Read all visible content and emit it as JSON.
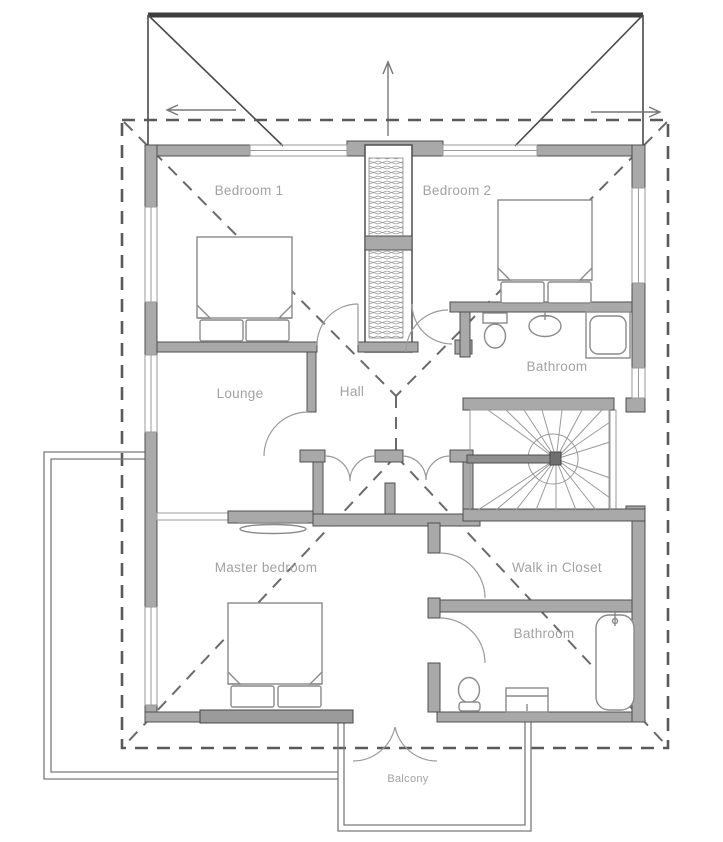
{
  "rooms": {
    "bedroom1": {
      "label": "Bedroom 1"
    },
    "bedroom2": {
      "label": "Bedroom 2"
    },
    "bathroom_upper": {
      "label": "Bathroom"
    },
    "lounge": {
      "label": "Lounge"
    },
    "hall": {
      "label": "Hall"
    },
    "master_bedroom": {
      "label": "Master bedroom"
    },
    "walk_in_closet": {
      "label": "Walk in Closet"
    },
    "bathroom_lower": {
      "label": "Bathroom"
    },
    "balcony": {
      "label": "Balcony"
    }
  },
  "colors": {
    "wall_fill": "#a9a9a9",
    "wall_outline": "#4f4f4f",
    "thin_line": "#8a8a8a",
    "dashed_line": "#5a5a5a",
    "label_text": "#a2a2a2",
    "background": "#ffffff"
  },
  "fixtures": [
    {
      "name": "double-bed-bedroom-1"
    },
    {
      "name": "double-bed-bedroom-2"
    },
    {
      "name": "double-bed-master"
    },
    {
      "name": "toilet-upper-bathroom"
    },
    {
      "name": "sink-upper-bathroom"
    },
    {
      "name": "shower-upper-bathroom"
    },
    {
      "name": "toilet-lower-bathroom"
    },
    {
      "name": "vanity-lower-bathroom"
    },
    {
      "name": "bathtub-lower-bathroom"
    },
    {
      "name": "winder-staircase"
    },
    {
      "name": "wardrobe-closet"
    },
    {
      "name": "chimney"
    },
    {
      "name": "sofa-shelf"
    },
    {
      "name": "balcony-railing"
    },
    {
      "name": "deck-railing"
    }
  ]
}
